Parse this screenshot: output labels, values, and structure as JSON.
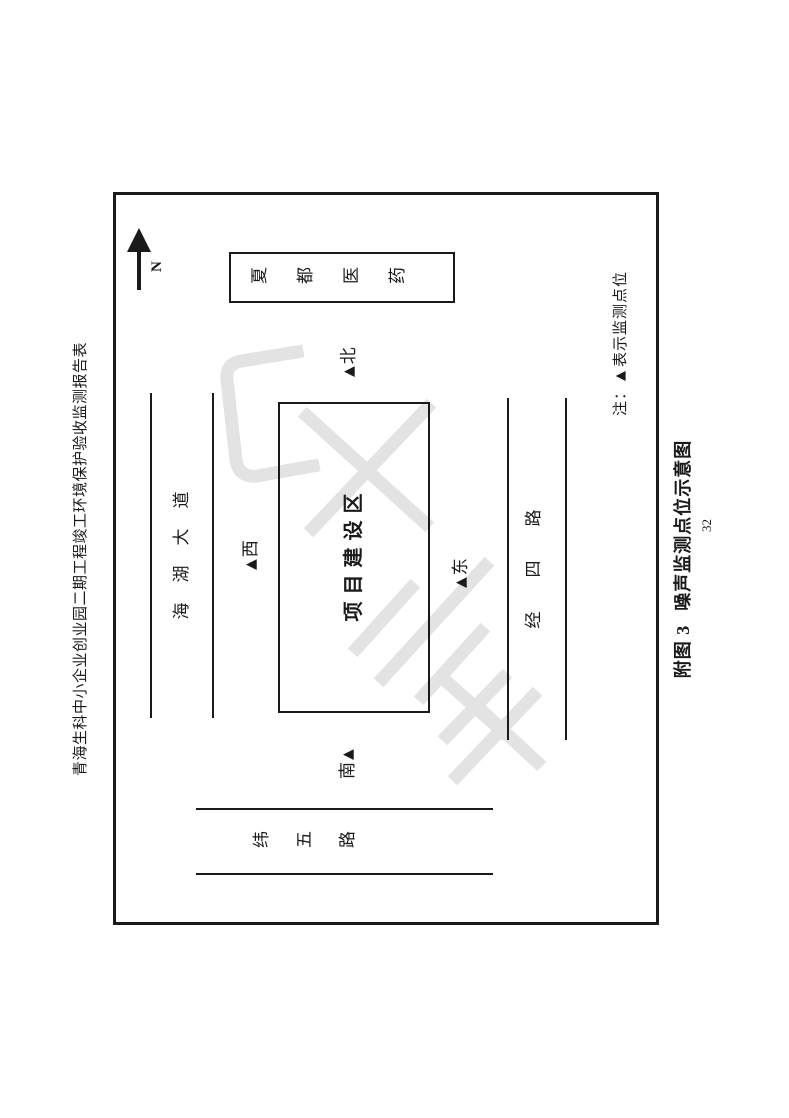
{
  "page": {
    "header_title": "青海生科中小企业创业园二期工程竣工环境保护验收监测报告表",
    "caption_prefix": "附图 3",
    "caption_title": "噪声监测点位示意图",
    "page_number": "32"
  },
  "compass": {
    "label": "N"
  },
  "map": {
    "building_label": "夏都医药",
    "project_area_label": "项目建设区",
    "road_north": "海湖大道",
    "road_east": "经四路",
    "road_south": "纬五路",
    "points": {
      "north": {
        "marker": "▲",
        "label": "北"
      },
      "west": {
        "marker": "▲",
        "label": "西"
      },
      "east": {
        "marker": "▲",
        "label": "东"
      },
      "south": {
        "marker": "▲",
        "label": "南"
      }
    },
    "note": {
      "prefix": "注：",
      "marker": "▲",
      "text": "表示监测点位"
    }
  },
  "colors": {
    "ink": "#1a1a1a",
    "watermark": "#e3e3e3",
    "background": "#ffffff"
  }
}
